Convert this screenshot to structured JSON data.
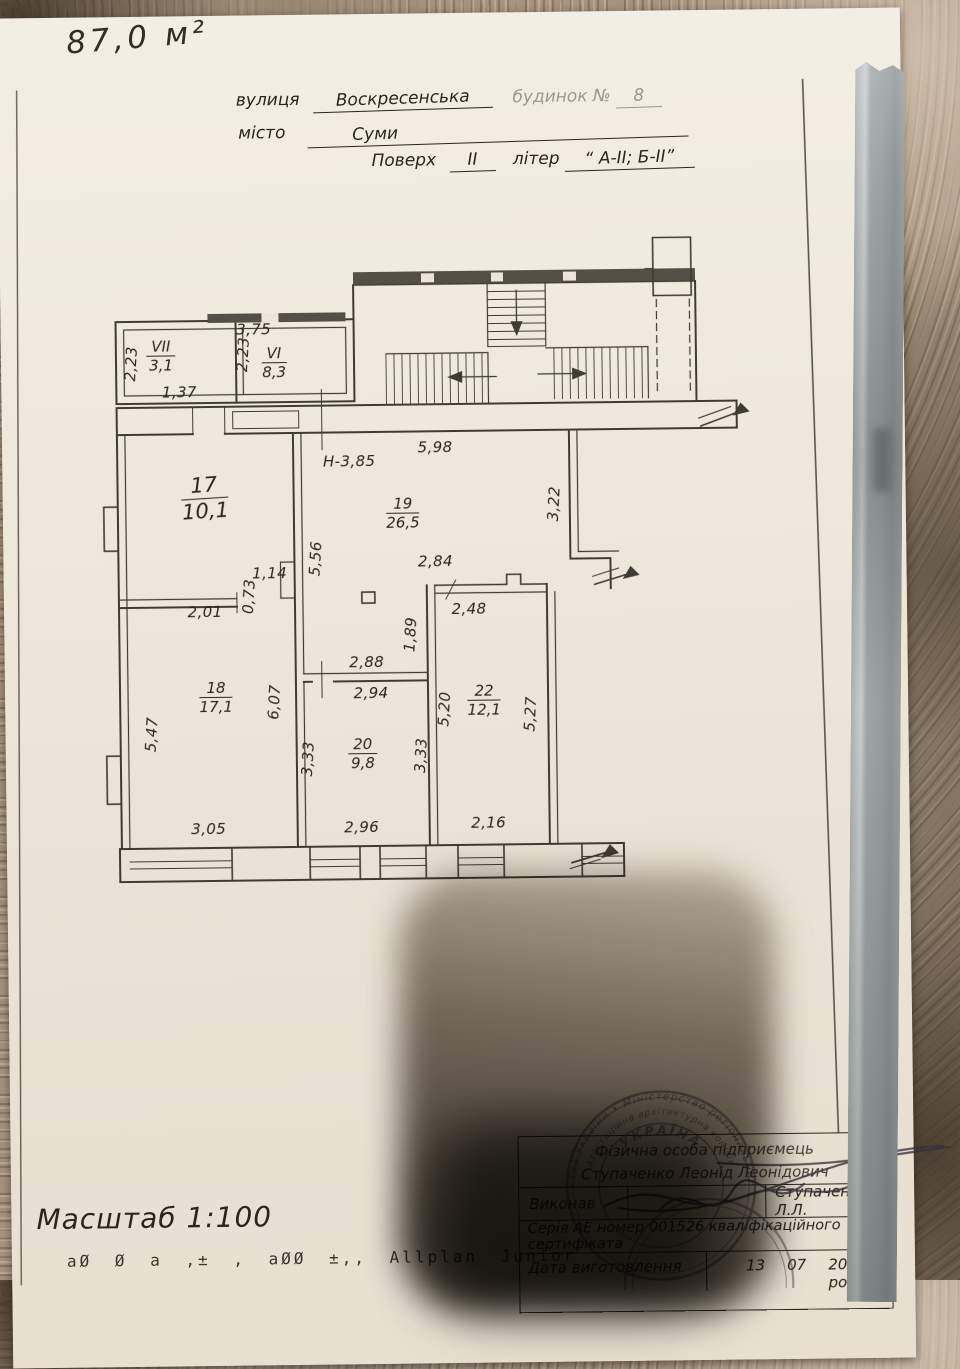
{
  "photo": {
    "area_note": "87,0 м²"
  },
  "header": {
    "street_label": "вулиця",
    "street_value": "Воскресенська",
    "building_label": "будинок №",
    "building_value": "8",
    "city_label": "місто",
    "city_value": "Суми",
    "floor_label": "Поверх",
    "floor_value": "ІІ",
    "letter_label": "літер",
    "letter_value": "“ А-ІІ; Б-ІІ”"
  },
  "plan": {
    "height_note": "Н-3,85",
    "rooms": [
      {
        "id": "VII",
        "area": "3,1"
      },
      {
        "id": "VI",
        "area": "8,3"
      },
      {
        "id": "17",
        "area": "10,1"
      },
      {
        "id": "19",
        "area": "26,5"
      },
      {
        "id": "18",
        "area": "17,1"
      },
      {
        "id": "20",
        "area": "9,8"
      },
      {
        "id": "22",
        "area": "12,1"
      }
    ],
    "dims": [
      "3,75",
      "2,23",
      "2,23",
      "1,37",
      "5,98",
      "3,22",
      "5,56",
      "1,14",
      "0,73",
      "2,01",
      "2,84",
      "2,48",
      "1,89",
      "2,88",
      "2,94",
      "6,07",
      "5,47",
      "3,33",
      "3,33",
      "5,20",
      "5,27",
      "3,05",
      "2,96",
      "2,16"
    ]
  },
  "footer": {
    "scale": "Масштаб 1:100",
    "codes": "аØ  Ø а  ‚± ‚  аØØ   ±‚‚ Allplan Junior"
  },
  "title_block": {
    "entity_line1": "Фізична особа підприємець",
    "entity_line2": "Ступаченко Леонід Леонідович",
    "author_label": "Виконав",
    "author_value": "Ступаченко Л.Л.",
    "series_line": "Серія АЕ номер 001526 кваліфікаційного сертифіката",
    "date_label": "Дата виготовлення",
    "date_day": "13",
    "date_month": "07",
    "date_year": "2017 року"
  },
  "stamp": {
    "outer": "• господарства України • Міністерство регіонального розвитку",
    "inner": "Атестаційна архітектурна комісія",
    "center": "УКРАЇНА"
  }
}
